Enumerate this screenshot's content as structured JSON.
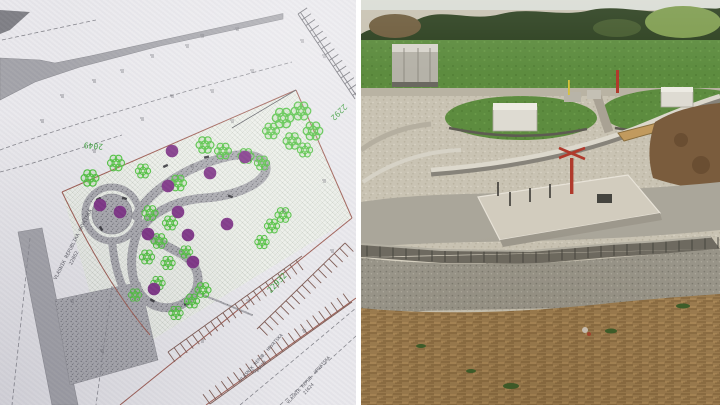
{
  "collage": {
    "left_caption": "landscape site plan drawing",
    "right_caption": "construction site photo"
  },
  "site_plan": {
    "parcel_labels": {
      "p2049": "2049",
      "p2292": "2292",
      "p22932": "22932"
    },
    "owner_labels": {
      "left_name": "VLASNIK REPUBLIKA HRVATSKA",
      "left_parcel": "22862",
      "bottom_a_name": "VLASNIK REPUB. HRVATSKA",
      "bottom_a_parcel": "21623",
      "bottom_b_name": "VLASNIK REPUB. HRVATSKA",
      "bottom_b_parcel": "21624"
    },
    "colors": {
      "paper": "#e9e8ec",
      "road_gray": "#a3a3a9",
      "path_gray": "#a9a9ae",
      "tree_green": "#4cc13c",
      "planting_purple": "#7d3285",
      "boundary_red": "#9c5a50",
      "parking_tick": "#7d5a52",
      "label_green": "#3f9f3f"
    }
  },
  "photo": {
    "colors": {
      "treeline_green": "#2c401f",
      "meadow_green": "#5d8c3f",
      "gravel_beige": "#c9c3b3",
      "concrete_pad": "#d2ccbe",
      "block_wall_gray": "#6e6a60",
      "soil_brown": "#9c7c4f",
      "marker_red": "#b03a2c",
      "plank_wood": "#c19a5e"
    }
  }
}
